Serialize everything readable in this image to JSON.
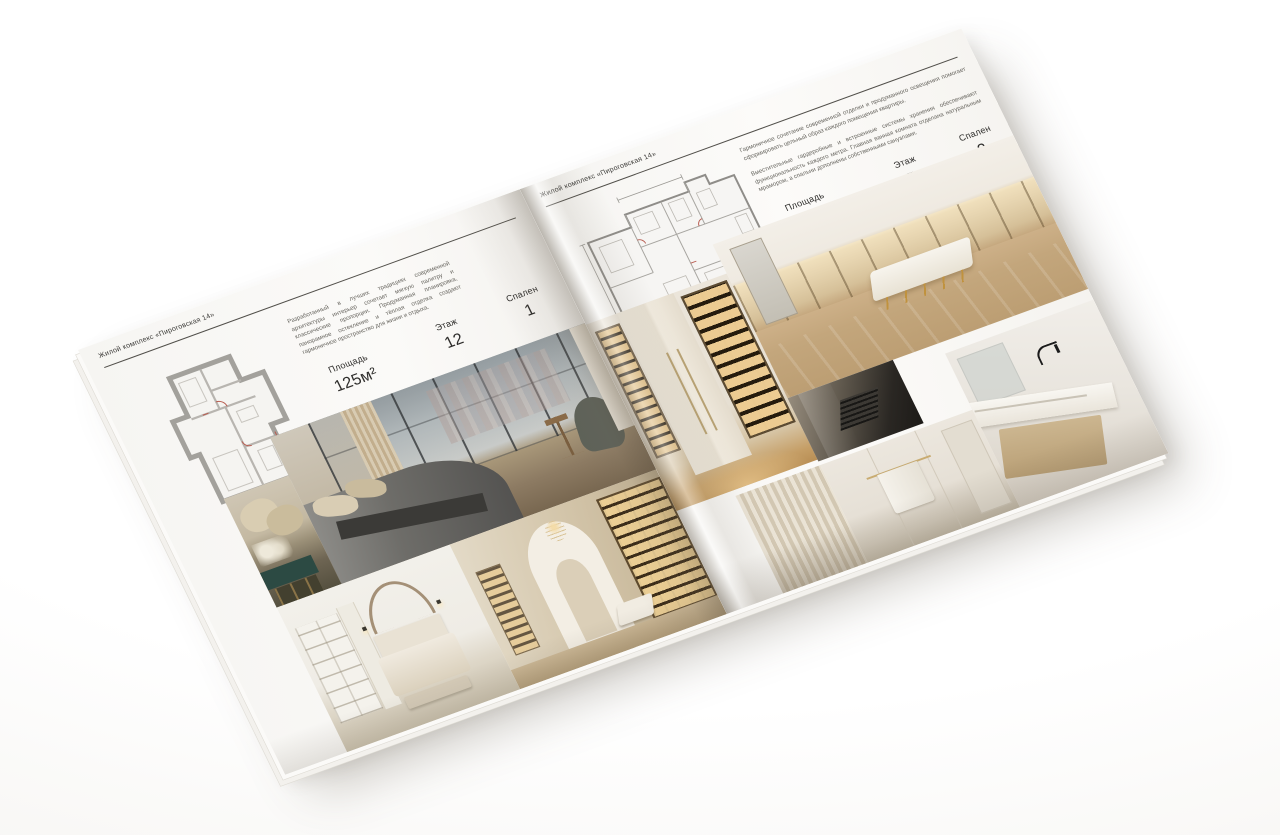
{
  "brochure": {
    "header_left": "Жилой комплекс «Пироговская 14»",
    "header_right": "Жилой комплекс «Пироговская 14»",
    "left_page": {
      "description": "Разработанный в лучших традициях современной архитектуры интерьер сочетает мягкую палитру и классические пропорции. Продуманная планировка, панорамное остекление и тёплая отделка создают гармоничное пространство для жизни и отдыха.",
      "stats": [
        {
          "label": "Площадь",
          "value": "125м²"
        },
        {
          "label": "Этаж",
          "value": "12"
        },
        {
          "label": "Спален",
          "value": "1"
        }
      ],
      "floor_plan": "План квартиры 125 м²",
      "photos": [
        {
          "name": "bedroom-panorama",
          "description": "Спальня с панорамными окнами и видом на город"
        },
        {
          "name": "bed-pillows-detail",
          "description": "Изголовье кровати с подушками и тумбой с цветами"
        },
        {
          "name": "white-bedroom",
          "description": "Светлая спальня с декоративной аркой и стеллажом"
        },
        {
          "name": "gallery-corridor",
          "description": "Коридор со встроенными подсвеченными стеллажами"
        }
      ]
    },
    "right_page": {
      "description_1": "Гармоничное сочетание современной отделки и продуманного освещения помогает сформировать цельный образ каждого помещения квартиры.",
      "description_2": "Вместительные гардеробные и встроенные системы хранения обеспечивают функциональность каждого метра. Главная ванная комната отделана натуральным мрамором, а спальни дополнены собственными санузлами.",
      "stats": [
        {
          "label": "Площадь",
          "value": "200м²"
        },
        {
          "label": "Этаж",
          "value": "5"
        },
        {
          "label": "Спален",
          "value": "2"
        }
      ],
      "floor_plan": "План квартиры 200 м²",
      "photos": [
        {
          "name": "wardrobe-display",
          "description": "Гардероб со стеклянными витринами и подсветкой"
        },
        {
          "name": "dressing-room-island",
          "description": "Гардеробная с островом и подсвеченными полками"
        },
        {
          "name": "dark-counter",
          "description": "Тёмная столешница с варочной панелью"
        },
        {
          "name": "fluted-panel",
          "description": "Фрагмент рифлёной стеновой панели"
        },
        {
          "name": "bathroom-towel",
          "description": "Ванная комната с полотенцем на рейлинге"
        },
        {
          "name": "marble-vanity",
          "description": "Мраморная столешница с чёрным смесителем"
        }
      ]
    },
    "colors": {
      "accent_gold": "#b98f55",
      "plan_red": "#b85c50",
      "paper": "#f7f6f3"
    }
  }
}
